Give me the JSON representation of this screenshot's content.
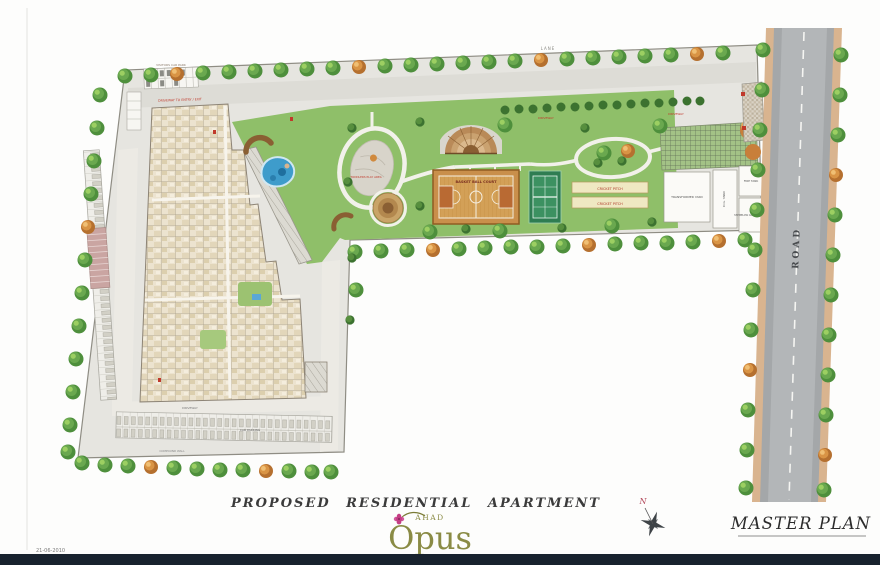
{
  "title_block": {
    "project_type": "PROPOSED  RESIDENTIAL  APARTMENT",
    "brand": "AHAD",
    "project_name": "Opus",
    "drawing_name": "MASTER PLAN",
    "date": "21-06-2010",
    "north_label": "N"
  },
  "plan": {
    "labels": {
      "lane": "LANE",
      "road": "ROAD",
      "basketball": "BASKET BALL COURT",
      "cricket_1": "CRICKET PITCH",
      "cricket_2": "CRICKET PITCH",
      "toddlers": "TODDLERS PLAY AREA",
      "visitors": "VISITORS CAR PARK",
      "driveway_top_left": "DRIVEWAY TO ENTRY / EXIT",
      "driveway_mid": "DRIVEWAY",
      "driveway_right": "DRIVEWAY",
      "car_parking": "CAR PARKING",
      "driveway_bottom": "DRIVEWAY",
      "compound_wall": "COMPOUND WALL"
    },
    "utilities": {
      "transformer": "TRANSFORMER YARD",
      "dg": "D.G. YARD",
      "fire": "FIRE TANK",
      "stp": "STP BELOW CAR PARK AREA"
    }
  },
  "colors": {
    "brand_olive": "#8a8b45",
    "flower_pink": "#c43e84",
    "footer_bar": "#18222e",
    "lawn": "#8fbf69",
    "road_gray": "#a4a7a9",
    "court_wood": "#c98f4b",
    "tennis_green": "#2f7d52",
    "pool_blue": "#3e9ccb"
  }
}
